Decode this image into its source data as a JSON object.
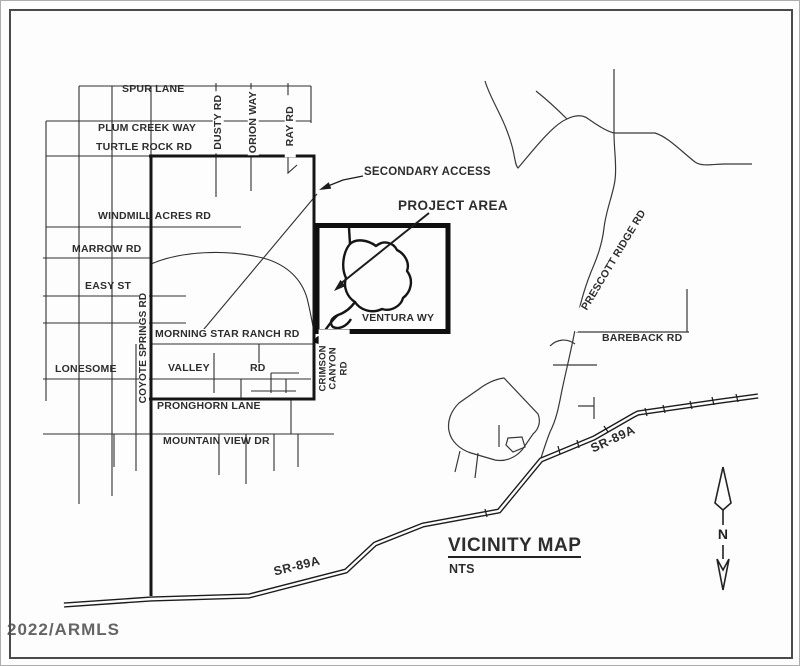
{
  "map": {
    "title": "VICINITY MAP",
    "scale": "NTS",
    "watermark": "2022/ARMLS",
    "north_label": "N",
    "annotations": {
      "project_area": "PROJECT AREA",
      "secondary_access": "SECONDARY ACCESS"
    },
    "road_labels": {
      "spur_lane": "SPUR LANE",
      "plum_creek_way": "PLUM CREEK WAY",
      "turtle_rock_rd": "TURTLE ROCK RD",
      "dusty_rd": "DUSTY RD",
      "orion_way": "ORION WAY",
      "ray_rd": "RAY RD",
      "windmill_acres_rd": "WINDMILL ACRES RD",
      "marrow_rd": "MARROW RD",
      "easy_st": "EASY ST",
      "coyote_springs_rd": "COYOTE SPRINGS RD",
      "morning_star_ranch_rd": "MORNING STAR RANCH RD",
      "lonesome": "LONESOME",
      "valley": "VALLEY",
      "valley_rd_suffix": "RD",
      "pronghorn_lane": "PRONGHORN LANE",
      "mountain_view_dr": "MOUNTAIN VIEW DR",
      "crimson_canyon_rd": "CRIMSON\nCANYON\nRD",
      "ventura_wy": "VENTURA WY",
      "prescott_ridge_rd": "PRESCOTT RIDGE RD",
      "bareback_rd": "BAREBACK RD",
      "sr_89a": "SR-89A"
    }
  }
}
